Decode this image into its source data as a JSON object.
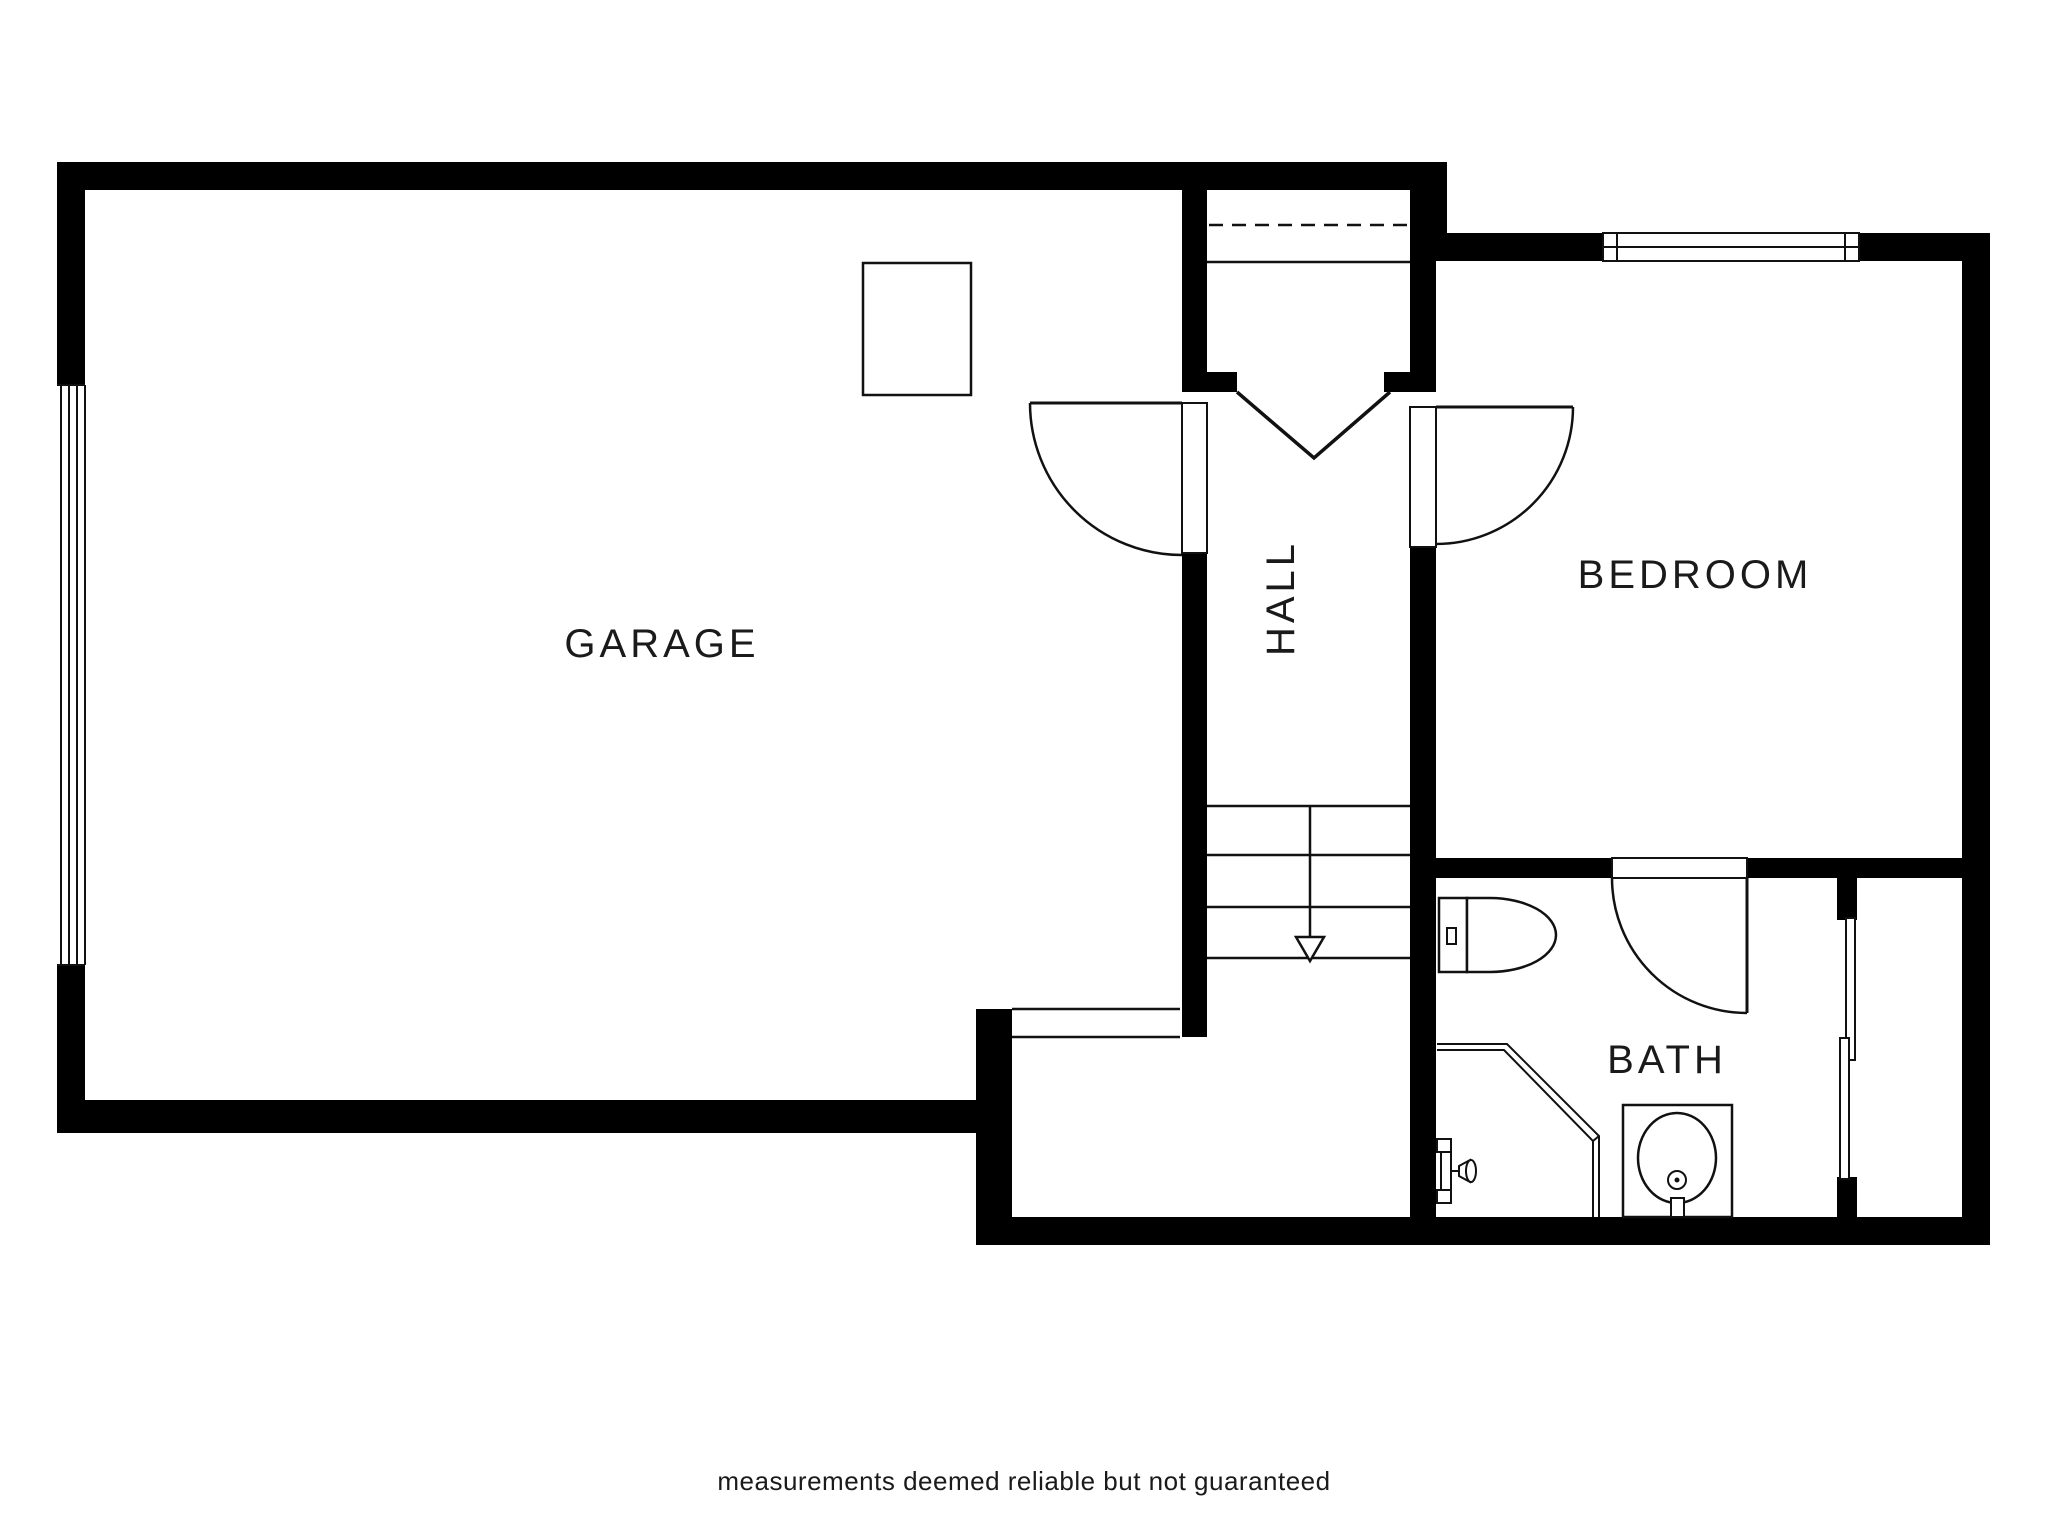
{
  "plan": {
    "title": "floor-plan",
    "rooms": {
      "garage": {
        "label": "GARAGE"
      },
      "hall": {
        "label": "HALL"
      },
      "bedroom": {
        "label": "BEDROOM"
      },
      "bath": {
        "label": "BATH"
      }
    },
    "fixtures": [
      "garage-overhead-door",
      "water-heater-box",
      "entry-double-door",
      "stairs-down",
      "garage-hall-door",
      "bedroom-door",
      "bath-door",
      "bedroom-window",
      "bath-sliding-window",
      "toilet",
      "shower-enclosure",
      "shower-valve",
      "sink-vanity"
    ],
    "colors": {
      "wall": "#000000",
      "line": "#111111",
      "background": "#ffffff",
      "text": "#1a1a1a"
    },
    "footer": {
      "disclaimer": "measurements deemed reliable but not guaranteed"
    }
  }
}
